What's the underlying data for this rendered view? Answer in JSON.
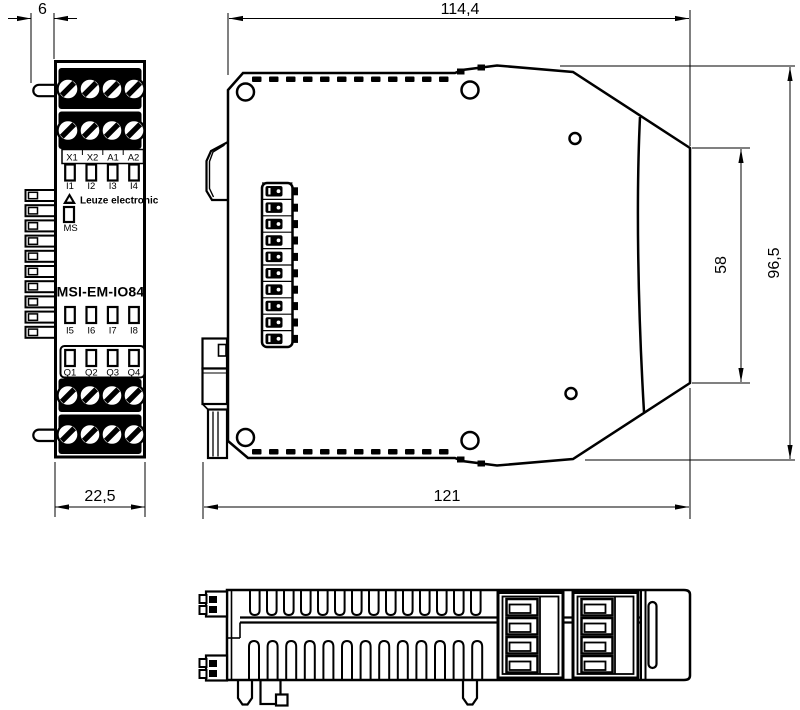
{
  "drawing": {
    "dimensions": {
      "pin_offset": "6",
      "front_width": "22,5",
      "top_width": "114,4",
      "bottom_width": "121",
      "recess_height": "58",
      "total_height": "96,5"
    },
    "front": {
      "brand": "Leuze electronic",
      "model": "MSI-EM-IO84",
      "ms_label": "MS",
      "terminals": [
        "X1",
        "X2",
        "A1",
        "A2"
      ],
      "inputs_top": [
        "I1",
        "I2",
        "I3",
        "I4"
      ],
      "inputs_bottom": [
        "I5",
        "I6",
        "I7",
        "I8"
      ],
      "outputs": [
        "Q1",
        "Q2",
        "Q3",
        "Q4"
      ]
    },
    "colors": {
      "line": "#000000",
      "background": "#ffffff"
    }
  }
}
